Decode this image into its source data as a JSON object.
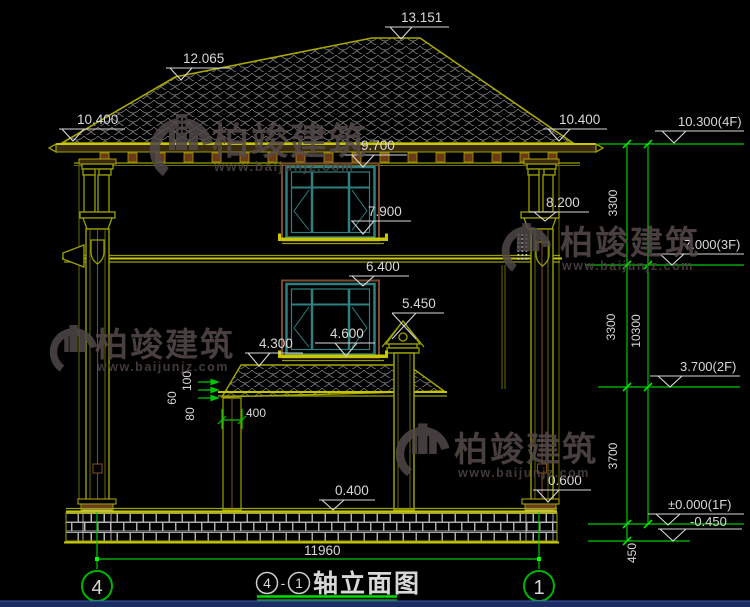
{
  "drawing": {
    "title": {
      "bubble_left": "4",
      "separator": "-",
      "bubble_right": "1",
      "text": "轴立面图"
    },
    "axis_bubbles": {
      "left": "4",
      "right": "1"
    },
    "elevation_markers": {
      "ridge_main": "13.151",
      "ridge_left": "12.065",
      "eave_left": "10.400",
      "eave_right": "10.400",
      "window3_head": "9.700",
      "capital_right": "8.200",
      "window3_sill": "7.900",
      "window2_head": "6.400",
      "porch_cap": "5.450",
      "window2_sill": "4.600",
      "porch_eave": "4.300",
      "plinth_top": "0.400",
      "pedestal_top": "0.600"
    },
    "levels": {
      "f4": "10.300(4F)",
      "f3": "7.000(3F)",
      "f2": "3.700(2F)",
      "f1": "±0.000(1F)",
      "below_grade": "-0.450"
    },
    "vertical_dims": {
      "upper": "3300",
      "middle": "3300",
      "overall": "10300",
      "lower": "3700",
      "footing": "450"
    },
    "linear_dims": {
      "total_width": "11960",
      "post_width": "400",
      "offset_a": "100",
      "offset_b": "60",
      "offset_c": "80"
    }
  },
  "watermark": {
    "name": "柏竣建筑",
    "url": "www.baijunjz.com"
  },
  "colors": {
    "background": "#000000",
    "line_olive": "#9aa000",
    "line_yellow": "#c8c800",
    "line_brown": "#8a5a2a",
    "window_teal": "#2e8080",
    "dim_green": "#00c800",
    "text_white": "#d8d8d8",
    "watermark": "#514848",
    "bottom_bar": "#1c2d63"
  }
}
